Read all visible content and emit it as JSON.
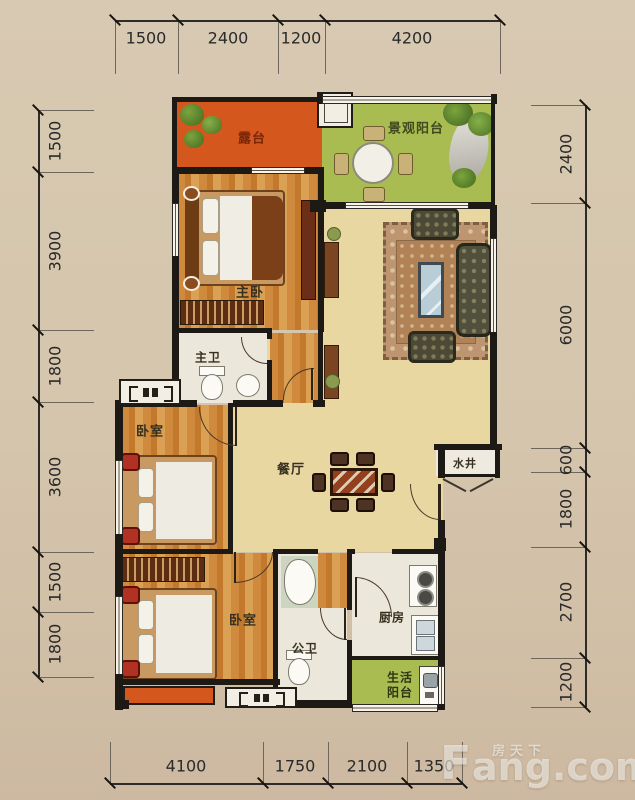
{
  "plan_title": "residential-floor-plan",
  "dimensions": {
    "top": [
      "1500",
      "2400",
      "1200",
      "4200"
    ],
    "left": [
      "1500",
      "3900",
      "1800",
      "3600",
      "1500",
      "1800"
    ],
    "right": [
      "2400",
      "6000",
      "600",
      "1800",
      "2700",
      "1200"
    ],
    "bottom": [
      "4100",
      "1750",
      "2100",
      "1350"
    ]
  },
  "rooms": {
    "terrace": "露台",
    "view_balcony": "景观阳台",
    "master_bedroom": "主卧",
    "master_bath": "主卫",
    "bedroom_mid": "卧室",
    "dining": "餐厅",
    "water_well": "水井",
    "bedroom_bottom": "卧室",
    "public_bath": "公卫",
    "kitchen": "厨房",
    "life_balcony_line1": "生活",
    "life_balcony_line2": "阳台"
  },
  "watermark": {
    "f": "F",
    "rest": "ang.com",
    "cn": "房天下"
  },
  "colors": {
    "wall": "#1d1a16",
    "terrace_orange": "#d4571e",
    "balcony_green": "#a9bc52",
    "wood_floor": "#cf8a3e",
    "hall_wheat": "#e9d7a2",
    "tile": "#ebe7db",
    "rug": "#bd9570",
    "accent_red": "#b13122",
    "page_beige": "#d5c5ac"
  },
  "icons": [
    "plant-icon",
    "rock-icon",
    "round-table-icon",
    "bed-icon",
    "wardrobe-icon",
    "toilet-icon",
    "basin-icon",
    "bathtub-icon",
    "sofa-icon",
    "armchair-icon",
    "coffee-table-icon",
    "rug",
    "dining-table-icon",
    "chair-icon",
    "stove-icon",
    "kitchen-sink-icon",
    "washing-machine-icon",
    "ac-platform-icon",
    "flue-box",
    "door-arc",
    "window"
  ]
}
